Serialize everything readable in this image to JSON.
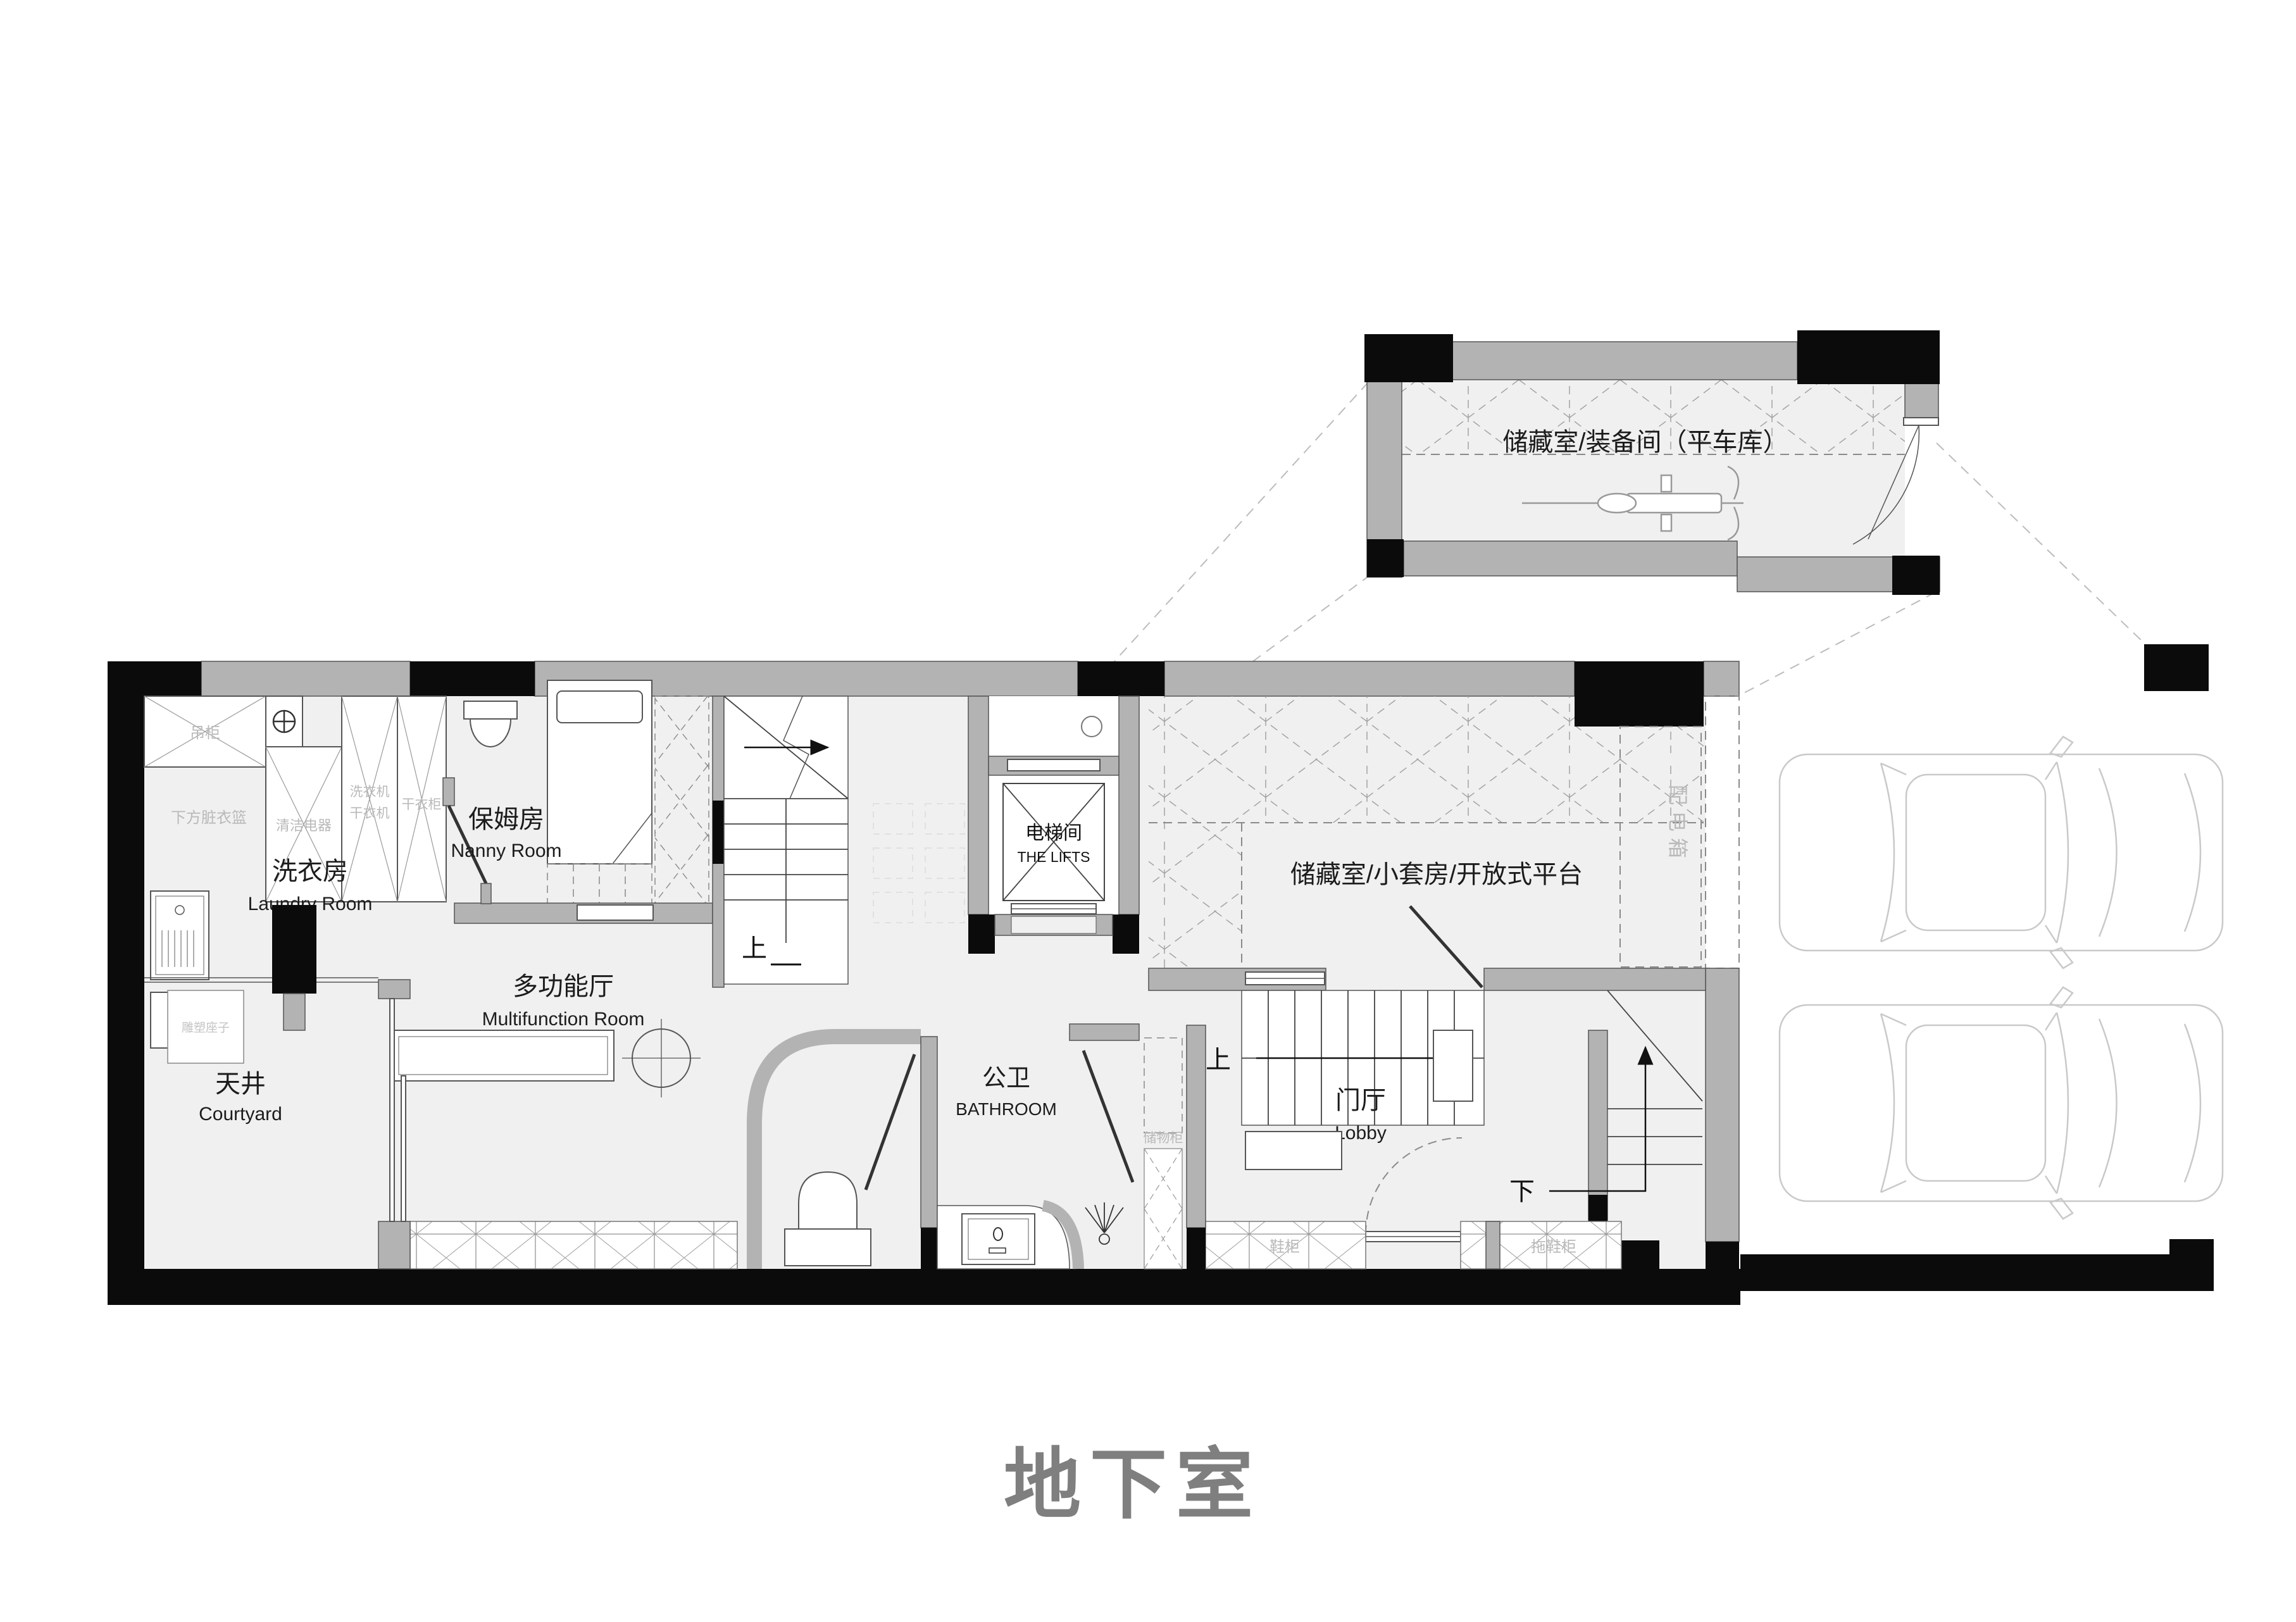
{
  "title": "地下室",
  "annex": {
    "label": "储藏室/装备间（平车库）"
  },
  "rooms": {
    "laundry": {
      "cn": "洗衣房",
      "en": "Laundry Room"
    },
    "nanny": {
      "cn": "保姆房",
      "en": "Nanny Room"
    },
    "lift": {
      "cn": "电梯间",
      "en": "THE LIFTS"
    },
    "storage": {
      "cn": "储藏室/小套房/开放式平台"
    },
    "multifunction": {
      "cn": "多功能厅",
      "en": "Multifunction Room"
    },
    "courtyard": {
      "cn": "天井",
      "en": "Courtyard"
    },
    "bathroom": {
      "cn": "公卫",
      "en": "BATHROOM"
    },
    "lobby": {
      "cn": "门厅",
      "en": "Lobby"
    }
  },
  "fixtures": {
    "hanging_cabinet": "吊柜",
    "laundry_basket": "下方脏衣篮",
    "cleaning_appliance": "清洁电器",
    "washer": "洗衣机",
    "dryer": "干衣机",
    "drying_cabinet": "干衣柜",
    "distribution_box": "配电箱",
    "storage_cabinet": "储物柜",
    "shoe_cabinet": "鞋柜",
    "slipper_cabinet": "拖鞋柜",
    "sculpture_pedestal": "雕塑座子"
  },
  "stairs": {
    "up": "上",
    "down": "下"
  },
  "colors": {
    "wall_black": "#0b0b0b",
    "wall_gray": "#b3b3b3",
    "floor": "#f0f0f0",
    "title_gray": "#7f7f7f",
    "small_label": "#b9b9b9"
  }
}
